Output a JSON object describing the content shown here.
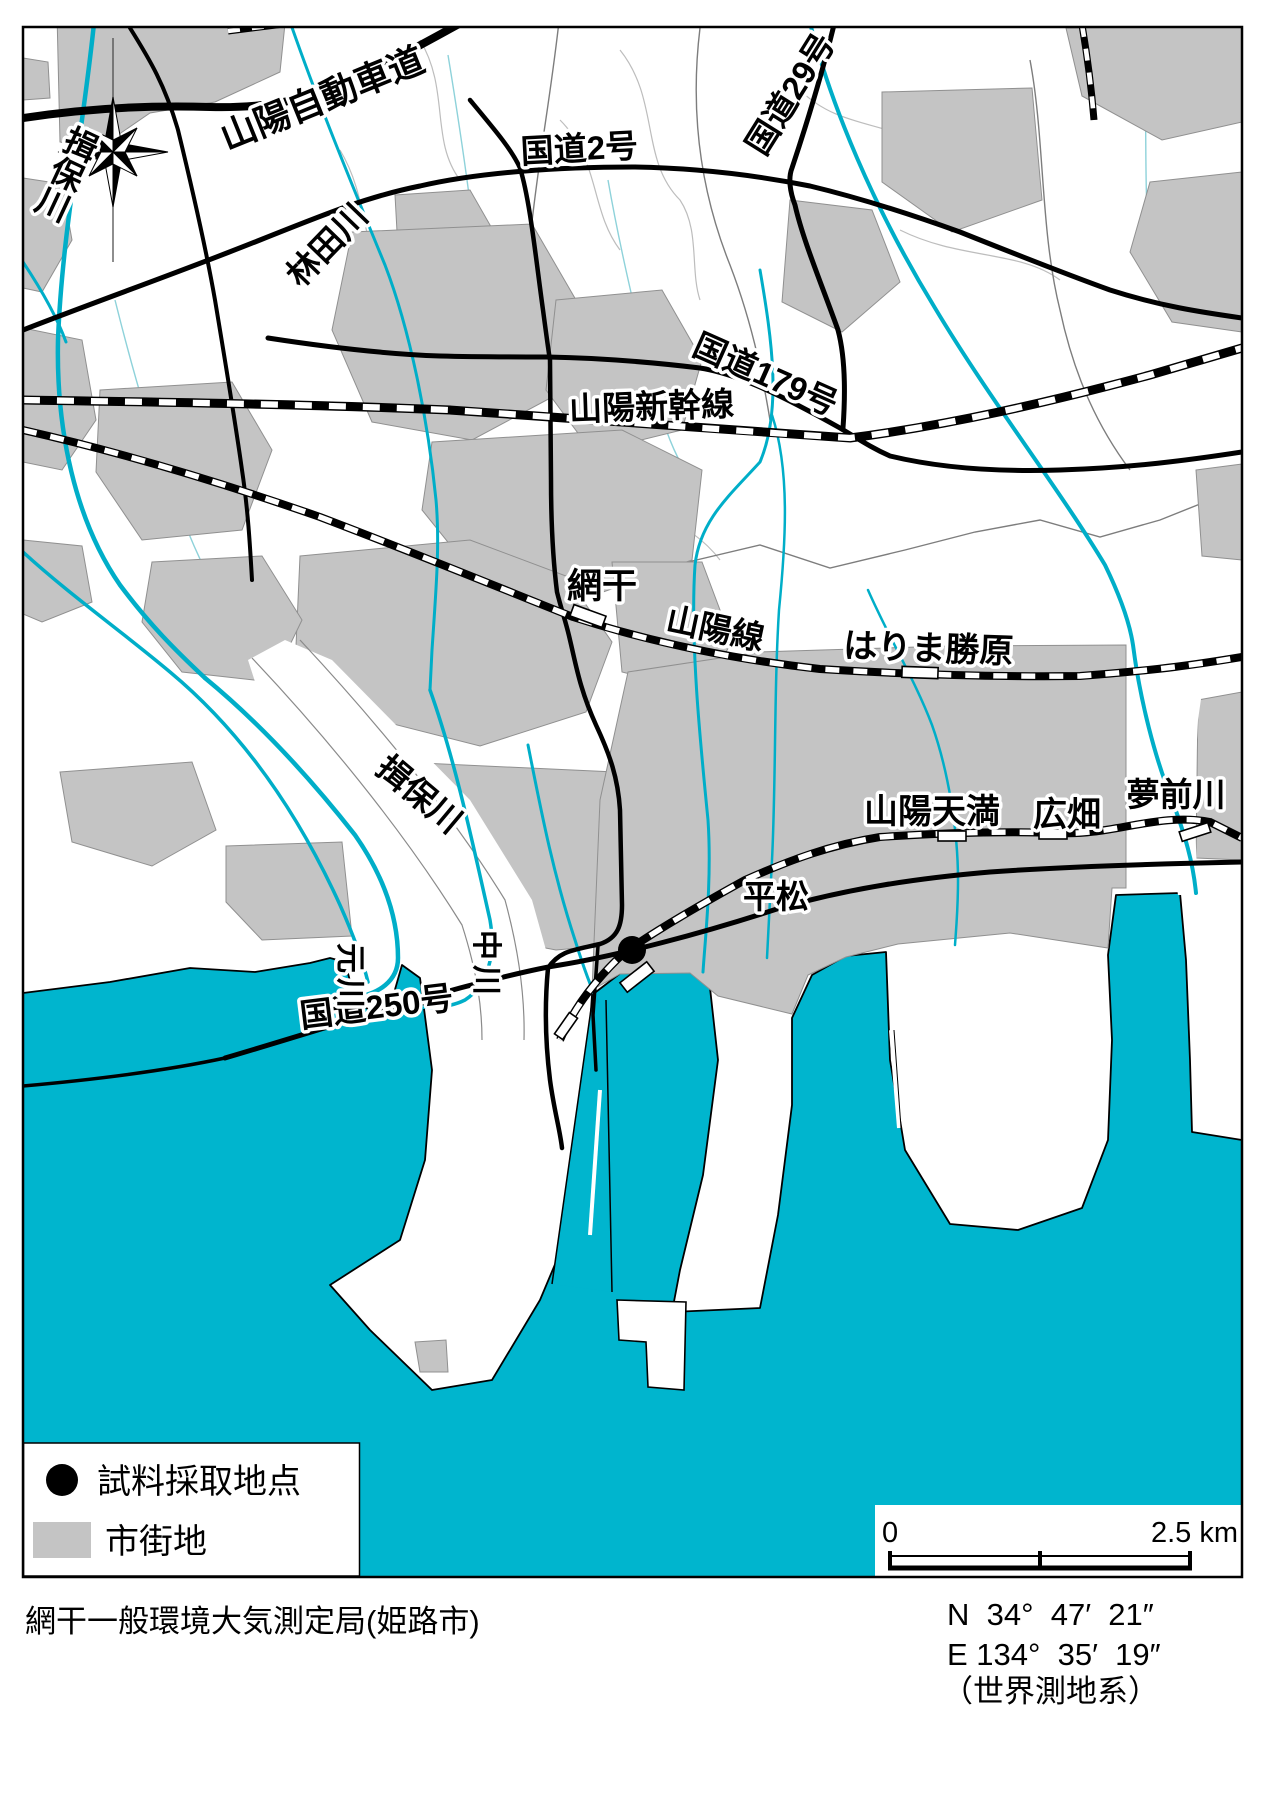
{
  "map": {
    "roads": {
      "expressway": "山陽自動車道",
      "route2": "国道2号",
      "route29": "国道29号",
      "route179": "国道179号",
      "route250": "国道250号"
    },
    "railways": {
      "shinkansen": "山陽新幹線",
      "sanyo_line": "山陽線"
    },
    "stations": {
      "aboshi": "網干",
      "harima_katsuhara": "はりま勝原",
      "sanyo_tenma": "山陽天満",
      "hirohata": "広畑",
      "hiramatsu": "平松"
    },
    "rivers": {
      "ibo_upper": "揖保川",
      "hayashida": "林田川",
      "ibo_lower": "揖保川",
      "yumesaki": "夢前川",
      "naka_c1": "中",
      "naka_c2": "川",
      "moto_c1": "元",
      "moto_c2": "川"
    }
  },
  "legend": {
    "sample_point": "試料採取地点",
    "urban_area": "市街地"
  },
  "scale_bar": {
    "start": "0",
    "end": "2.5 km"
  },
  "footer": {
    "title": "網干一般環境大気測定局(姫路市)",
    "lat": "N  34°  47′  21″",
    "lon": "E 134°  35′  19″",
    "datum": "（世界測地系）"
  },
  "colors": {
    "sea": "#00b5ce",
    "urban": "#c4c4c4",
    "river": "#00aec8",
    "road": "#000000"
  }
}
